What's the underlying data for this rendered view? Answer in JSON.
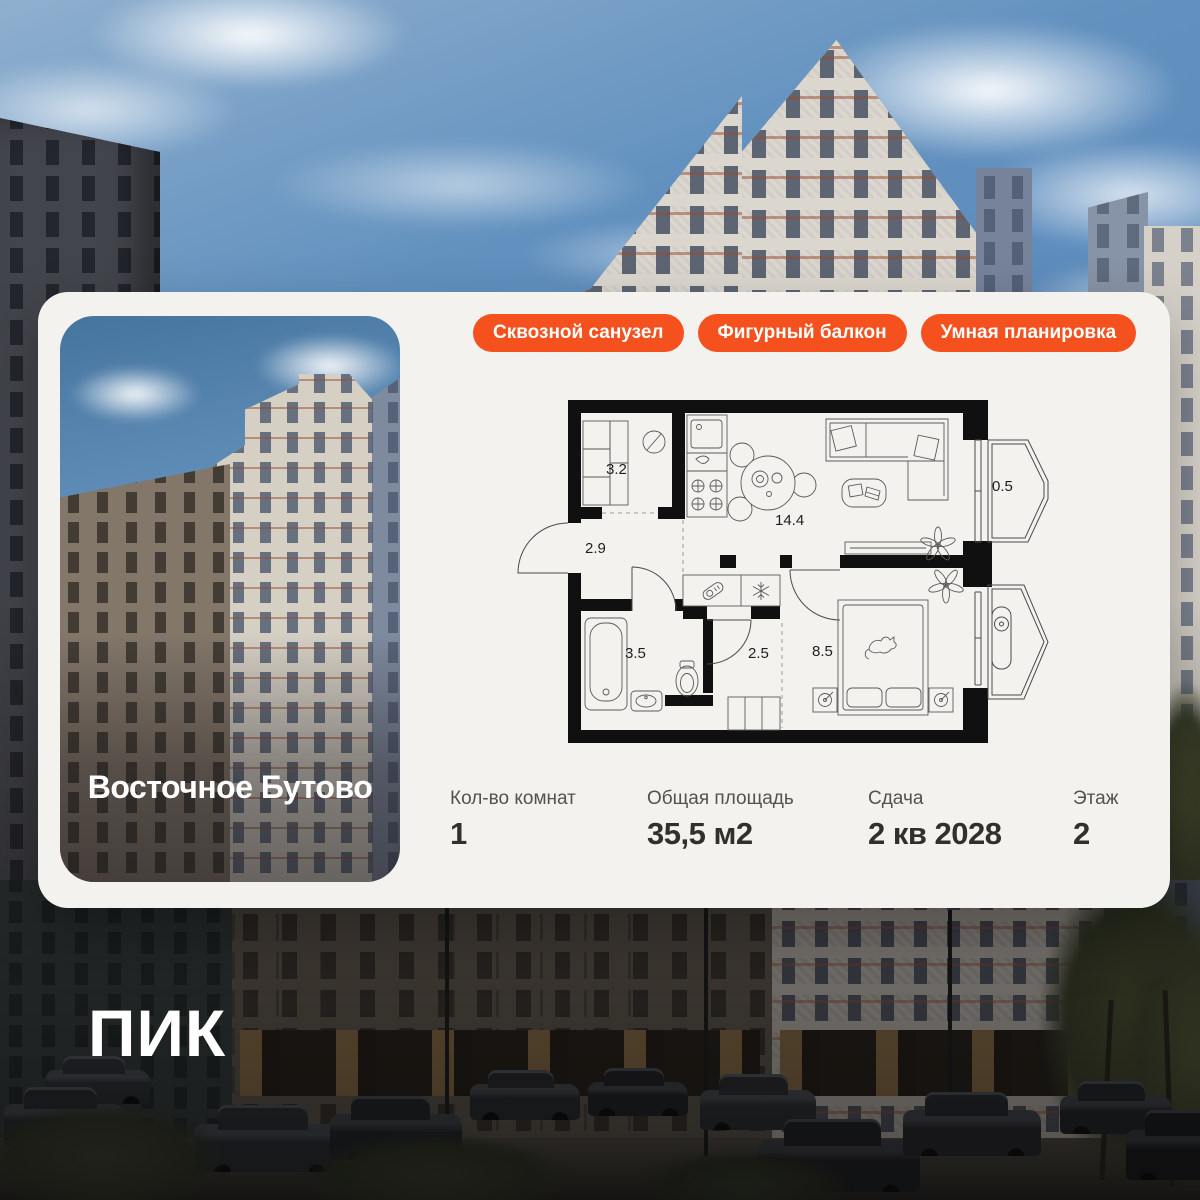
{
  "brand": {
    "logo_text": "ПИК"
  },
  "colors": {
    "accent_orange": "#F4511E",
    "card_bg": "#F4F2EF",
    "text_dark": "#32302D",
    "text_muted": "#55514E"
  },
  "project": {
    "name": "Восточное Бутово"
  },
  "badges": [
    {
      "label": "Сквозной санузел"
    },
    {
      "label": "Фигурный балкон"
    },
    {
      "label": "Умная планировка"
    }
  ],
  "floor_plan": {
    "rooms": [
      {
        "name": "storage",
        "area": "3.2"
      },
      {
        "name": "hallway",
        "area": "2.9"
      },
      {
        "name": "kitchen-living",
        "area": "14.4"
      },
      {
        "name": "balcony",
        "area": "0.5"
      },
      {
        "name": "bathroom",
        "area": "3.5"
      },
      {
        "name": "hall",
        "area": "2.5"
      },
      {
        "name": "bedroom",
        "area": "8.5"
      }
    ]
  },
  "stats": [
    {
      "label": "Кол-во комнат",
      "value": "1"
    },
    {
      "label": "Общая площадь",
      "value": "35,5 м2"
    },
    {
      "label": "Сдача",
      "value": "2 кв 2028"
    },
    {
      "label": "Этаж",
      "value": "2"
    }
  ]
}
